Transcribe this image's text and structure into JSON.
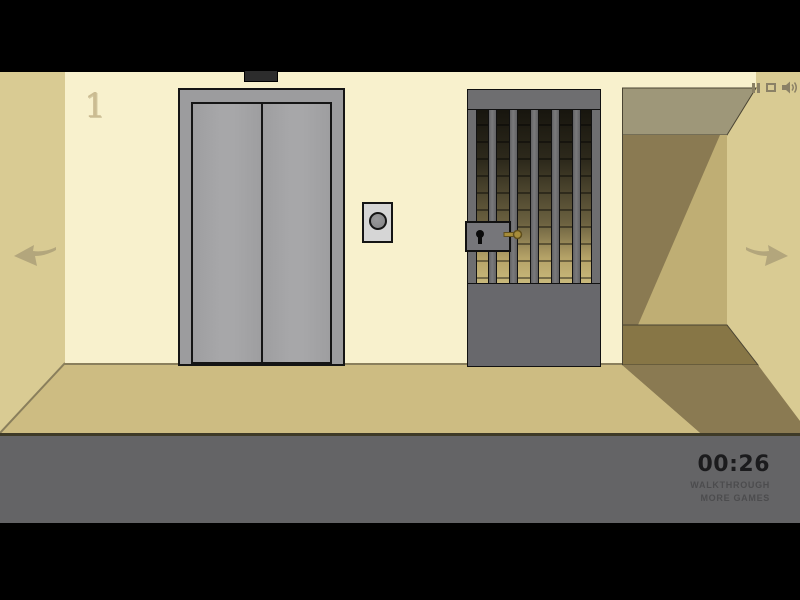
{
  "scene": {
    "floor_label": "1",
    "colors": {
      "wall_front": "#f8f1cd",
      "wall_side": "#d9cb93",
      "floor": "#cdbc82",
      "corridor_ceiling": "#9e9779",
      "corridor_lit": "#bfae74",
      "corridor_shadow": "#8a7a52",
      "corridor_floor": "#877646",
      "metal_frame": "#9c9c9e",
      "door_panel": "#a7a7a9",
      "gate_gray": "#6e6e70",
      "bottom_bar": "#646466",
      "key_brass": "#a68c3a",
      "arrow": "#b3a67c",
      "timer_text": "#1b1b1d",
      "link_text": "#4c4c4e",
      "icon_color": "#8b8166"
    },
    "objects": {
      "elevator": "elevator with closed double doors",
      "call_button": "round elevator call button",
      "gate": "gray barred prison gate with lock and brass key",
      "corridor": "dark corridor opening on the right"
    }
  },
  "hud": {
    "timer": "00:26",
    "walkthrough_label": "WALKTHROUGH",
    "more_games_label": "MORE GAMES",
    "icons": {
      "pause": "pause-icon",
      "quality": "quality-icon",
      "sound": "speaker-icon"
    }
  }
}
